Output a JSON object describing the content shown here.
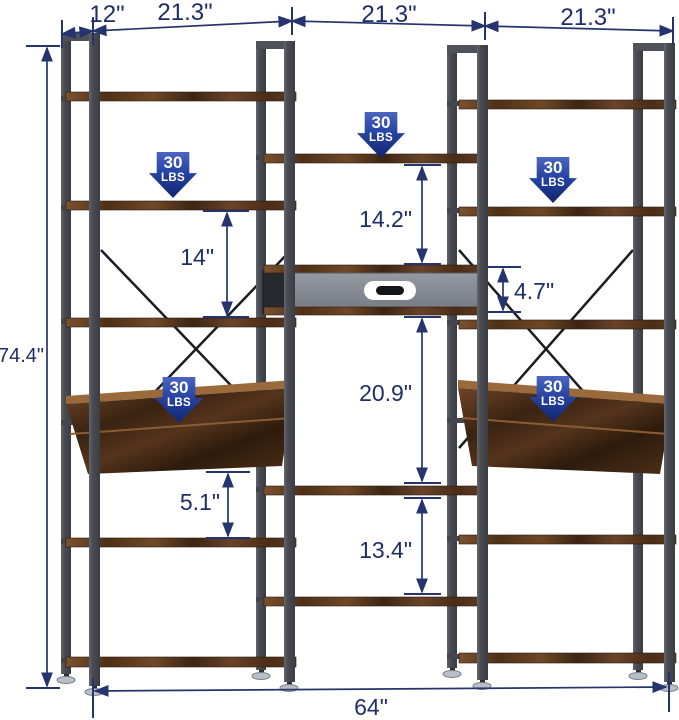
{
  "dimensions": {
    "depth": "12\"",
    "section_widths": [
      "21.3\"",
      "21.3\"",
      "21.3\""
    ],
    "total_height": "74.4\"",
    "total_width": "64\"",
    "left_shelf_gap": "14\"",
    "left_under_tilt_gap": "5.1\"",
    "mid_top_gap": "14.2\"",
    "drawer_height": "4.7\"",
    "mid_lower_gap": "20.9\"",
    "mid_bottom_gap": "13.4\""
  },
  "load_badges": [
    {
      "value": "30",
      "unit": "LBS",
      "position": "left-top"
    },
    {
      "value": "30",
      "unit": "LBS",
      "position": "middle-top"
    },
    {
      "value": "30",
      "unit": "LBS",
      "position": "right-top"
    },
    {
      "value": "30",
      "unit": "LBS",
      "position": "left-tilted-shelf"
    },
    {
      "value": "30",
      "unit": "LBS",
      "position": "right-tilted-shelf"
    }
  ],
  "colors": {
    "dimension_ink": "#1f2d68",
    "badge_gradient_top": "#4a66c0",
    "badge_gradient_bottom": "#12266b",
    "wood": "#5d3a20",
    "metal_frame": "#4a4d53",
    "drawer_front": "#8b9097"
  }
}
